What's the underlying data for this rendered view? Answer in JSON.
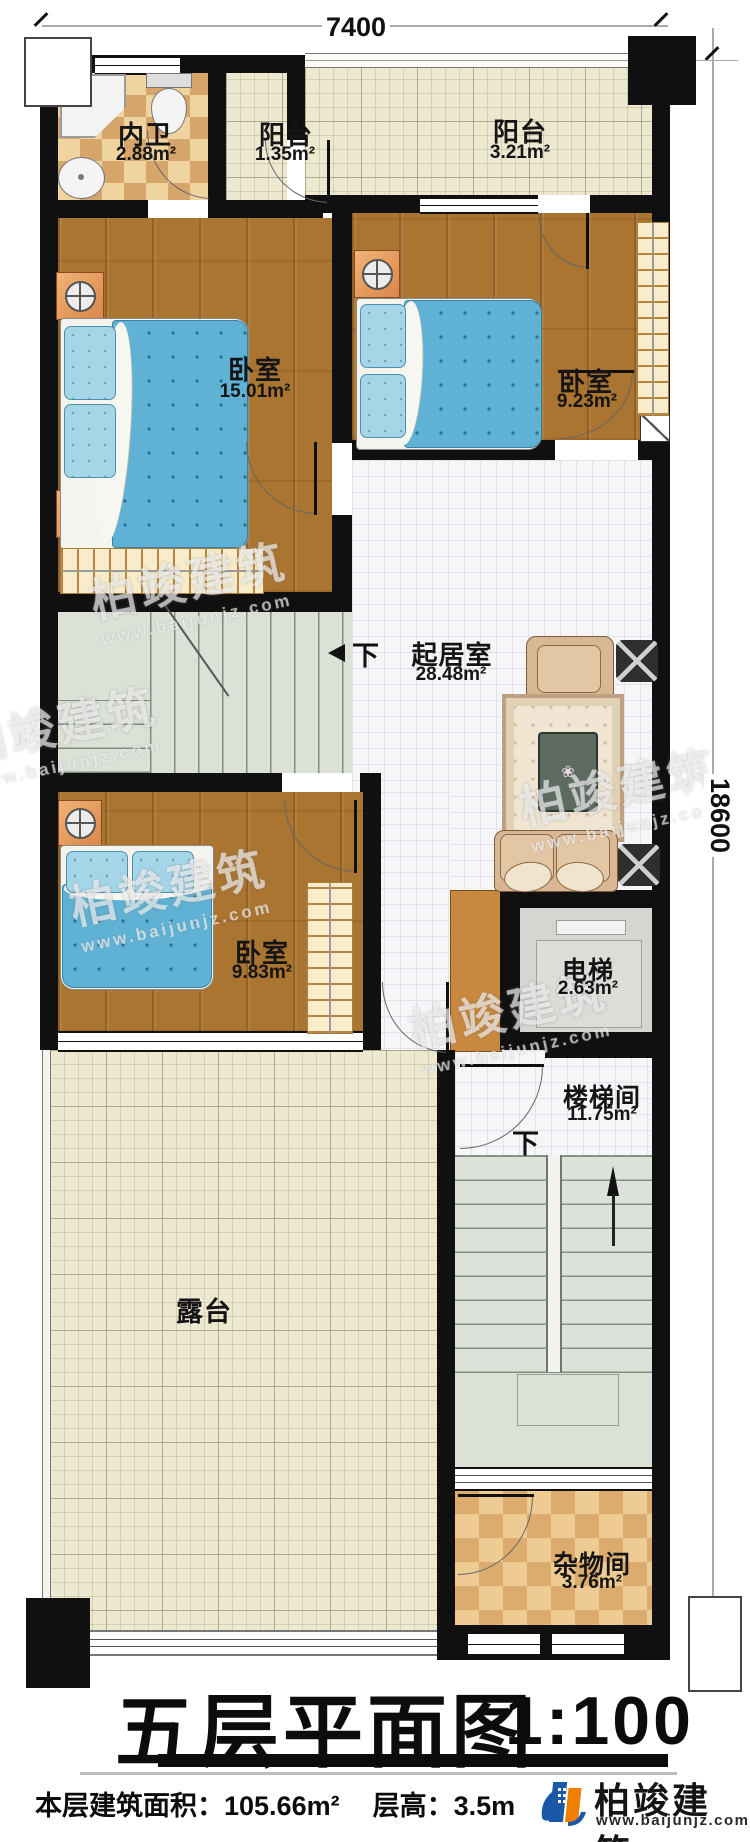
{
  "dimensions": {
    "width_label": "7400",
    "height_label": "18600"
  },
  "rooms": {
    "bathroom": {
      "name": "内卫",
      "area": "2.88m²"
    },
    "balcony_small": {
      "name": "阳台",
      "area": "1.35m²"
    },
    "balcony_large": {
      "name": "阳台",
      "area": "3.21m²"
    },
    "bedroom_master": {
      "name": "卧室",
      "area": "15.01m²"
    },
    "bedroom_right": {
      "name": "卧室",
      "area": "9.23m²"
    },
    "living_room": {
      "name": "起居室",
      "area": "28.48m²"
    },
    "bedroom_lower": {
      "name": "卧室",
      "area": "9.83m²"
    },
    "elevator": {
      "name": "电梯",
      "area": "2.63m²"
    },
    "stairwell": {
      "name": "楼梯间",
      "area": "11.75m²"
    },
    "terrace": {
      "name": "露台"
    },
    "storage": {
      "name": "杂物间",
      "area": "3.76m²"
    }
  },
  "stairs": {
    "down_label": "下"
  },
  "title": {
    "text": "五层平面图",
    "scale": "1:100"
  },
  "footer": {
    "area_info": "本层建筑面积：105.66m²",
    "height_info": "层高：3.5m"
  },
  "logo": {
    "name": "柏竣建筑",
    "website": "www.baijunjz.com"
  },
  "watermark": {
    "name": "柏竣建筑",
    "website": "www.baijunjz.com"
  },
  "colors": {
    "wall": "#101010",
    "wood_floor": "#aa7431",
    "bed_blanket": "#5fb2d3",
    "bathroom_tile": "#d6a569",
    "terrace_tile": "#ede8d0",
    "logo_blue": "#1a57a8",
    "logo_orange": "#f07f00"
  }
}
